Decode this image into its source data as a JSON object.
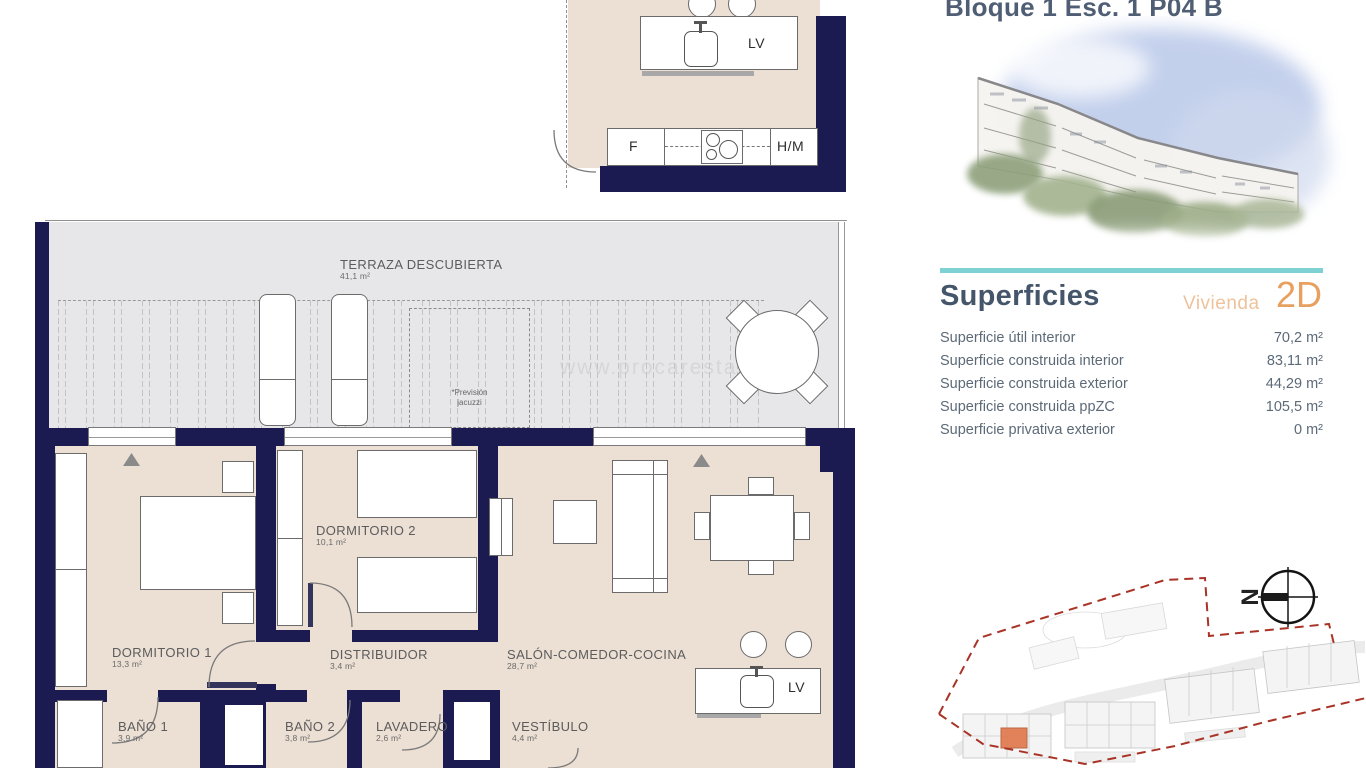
{
  "title": "Bloque 1 Esc. 1 P04 B",
  "watermark": "www.procarestate",
  "floorplan": {
    "rooms": {
      "terraza": {
        "name": "TERRAZA DESCUBIERTA",
        "area": "41,1 m²"
      },
      "dormitorio1": {
        "name": "DORMITORIO 1",
        "area": "13,3 m²"
      },
      "dormitorio2": {
        "name": "DORMITORIO 2",
        "area": "10,1 m²"
      },
      "distribuidor": {
        "name": "DISTRIBUIDOR",
        "area": "3,4 m²"
      },
      "salon": {
        "name": "SALÓN-COMEDOR-COCINA",
        "area": "28,7 m²"
      },
      "bano1": {
        "name": "BAÑO 1",
        "area": "3,9 m²"
      },
      "bano2": {
        "name": "BAÑO 2",
        "area": "3,8 m²"
      },
      "lavadero": {
        "name": "LAVADERO",
        "area": "2,6 m²"
      },
      "vestibulo": {
        "name": "VESTÍBULO",
        "area": "4,4 m²"
      }
    },
    "appliances": {
      "dishwasher": "LV",
      "fridge": "F",
      "oven_microwave": "H/M"
    },
    "jacuzzi_note_line1": "*Previsión",
    "jacuzzi_note_line2": "jacuzzi",
    "north_label": "N"
  },
  "superficies": {
    "heading": "Superficies",
    "unit_label": "Vivienda",
    "unit_type": "2D",
    "rows": [
      {
        "label": "Superficie útil interior",
        "value": "70,2 m²"
      },
      {
        "label": "Superficie construida interior",
        "value": "83,11 m²"
      },
      {
        "label": "Superficie construida exterior",
        "value": "44,29 m²"
      },
      {
        "label": "Superficie construida ppZC",
        "value": "105,5 m²"
      },
      {
        "label": "Superficie privativa exterior",
        "value": "0 m²"
      }
    ]
  },
  "colors": {
    "wall": "#1b1b52",
    "floor": "#ecdfd4",
    "terrace": "#e7e7ea",
    "teal_divider": "#7fd2d4",
    "heading": "#45566a",
    "accent_orange": "#e8a060",
    "unit_label_orange": "#eec29a",
    "boundary_red": "#a93326",
    "highlight_orange": "#e0794e"
  }
}
